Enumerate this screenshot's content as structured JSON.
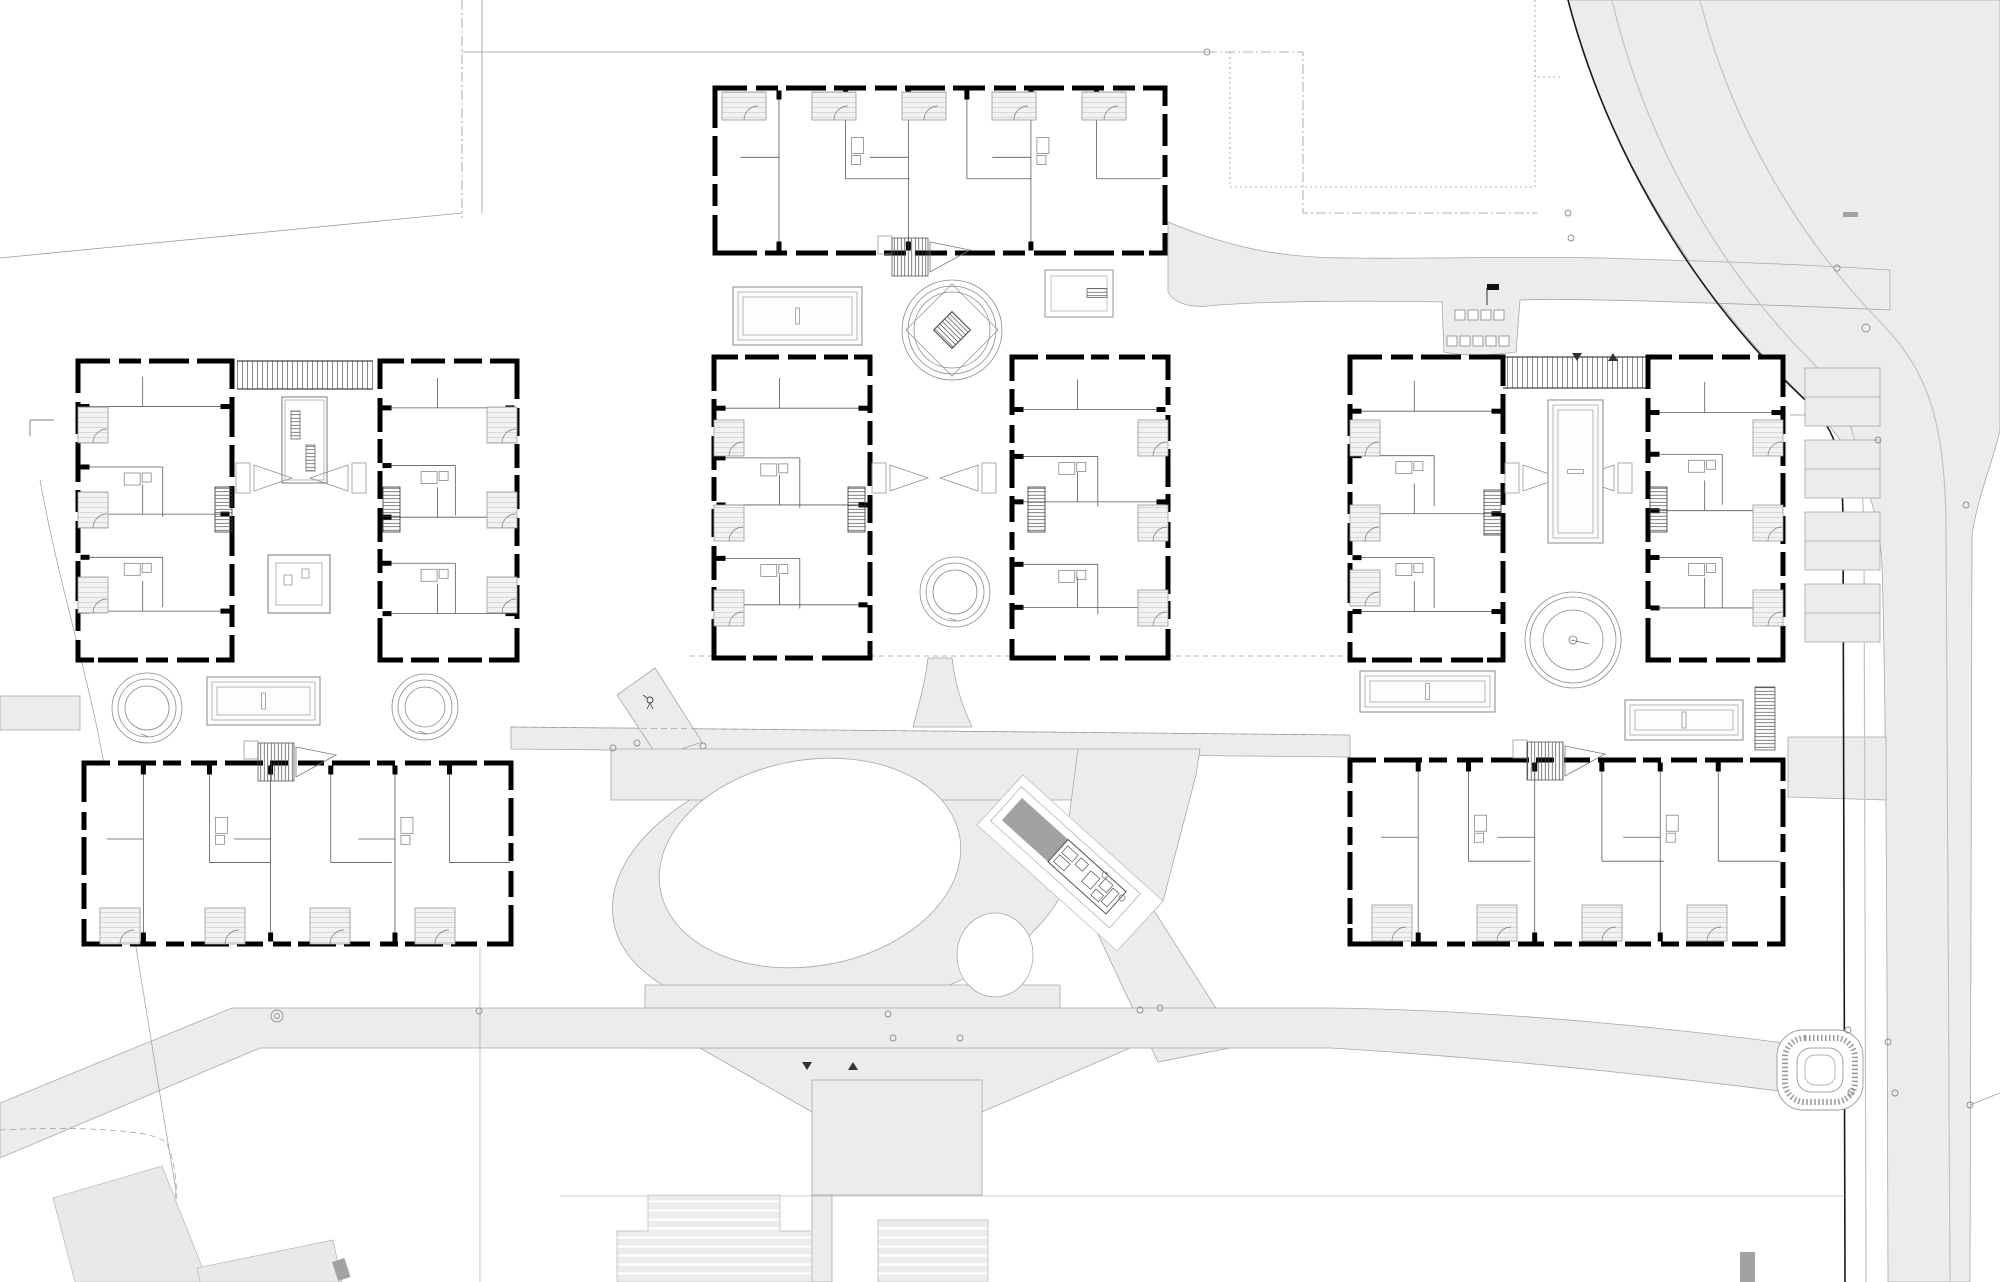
{
  "canvas": {
    "w": 2000,
    "h": 1282
  },
  "colors": {
    "paper": "#ffffff",
    "road_fill": "#ececec",
    "road_edge": "#a8a8a8",
    "wall": "#000000",
    "partition": "#5a5a5a",
    "faint_line": "#9a9a9a",
    "kerb": "#1a1a1a",
    "lane": "#c2c2c2",
    "context_fill": "#e9e9e9",
    "dark_object": "#a2a2a2",
    "hatch_line": "#4a4a4a"
  },
  "site": {
    "roads": [
      {
        "name": "east-road",
        "d": "M1568,0 H2000 V430 C1992,465 1978,495 1972,535 L1970,1282 H1888 C1887,900 1886,700 1882,565 C1878,485 1848,442 1798,392 C1702,298 1606,152 1568,0 Z"
      },
      {
        "name": "upper-path",
        "d": "M1168,222 C1240,252 1292,258 1352,258 C1432,259 1522,256 1602,258 C1702,261 1802,264 1890,270 L1890,310 C1702,302 1562,298 1520,300 L1516,352 C1488,356 1462,356 1444,352 L1442,302 C1330,300 1252,302 1208,306 C1184,308 1172,300 1168,292 Z"
      },
      {
        "name": "central-band-west",
        "d": "M0,696 H80 V730 H0 Z"
      },
      {
        "name": "central-band-mid",
        "d": "M511,727 L1350,735 L1350,757 L511,749 Z"
      },
      {
        "name": "central-band-east",
        "d": "M1788,737 L1886,737 L1886,800 L1788,797 Z"
      },
      {
        "name": "courtyard-funnel",
        "d": "M913,727 C920,700 926,678 928,658 L952,658 C955,684 962,706 972,727 Z"
      },
      {
        "name": "northwest-stub",
        "d": "M617,695 L655,668 L702,742 L658,757 Z"
      },
      {
        "name": "ring-bridge-north",
        "d": "M611,749 L1078,749 L1078,800 L611,800 Z"
      },
      {
        "name": "ring-bridge-south",
        "d": "M645,985 L1060,985 L1060,1048 L645,1048 Z"
      },
      {
        "name": "diagonal-link-north",
        "d": "M1078,749 L1200,749 L1196,775 L1163,901 L1117,951 L1062,872 Z"
      },
      {
        "name": "diagonal-link-south",
        "d": "M1096,930 L1146,898 L1240,1046 L1158,1062 Z"
      },
      {
        "name": "plaza-wedge",
        "d": "M700,1048 L1130,1048 L982,1112 L812,1112 Z"
      },
      {
        "name": "plaza",
        "d": "M812,1080 H982 V1195 H812 Z"
      },
      {
        "name": "plaza-stem",
        "d": "M812,1195 H832 V1282 H812 Z"
      },
      {
        "name": "bottom-road",
        "d": "M0,1103 L232,1008 L1330,1008 C1500,1010 1700,1030 1848,1052 L1848,1100 C1700,1080 1500,1058 1330,1048 L260,1048 L0,1158 Z"
      }
    ],
    "ring_ellipse": {
      "cx": 842,
      "cy": 881,
      "rx": 232,
      "ry": 131,
      "rot": -10
    },
    "white_islands": [
      {
        "name": "large-green-island",
        "cx": 810,
        "cy": 863,
        "rx": 152,
        "ry": 103,
        "rot": -10
      },
      {
        "name": "small-green-island",
        "cx": 995,
        "cy": 955,
        "rx": 38,
        "ry": 42,
        "rot": 0
      }
    ],
    "corridor_white": "977,825 1117,951 1163,901 1023,775",
    "lane_lines": [
      "M1612,0 C1645,140 1718,268 1812,362 C1852,404 1862,448 1864,530 L1866,1282",
      "M1700,0 C1730,120 1795,235 1884,326 C1932,376 1944,430 1946,520 L1950,1282"
    ],
    "kerb": "M1568,0 C1610,160 1700,300 1800,395 C1838,430 1842,450 1843,520 L1845,1282",
    "boundary_lines": [
      {
        "d": "M0,258 L462,213",
        "dash": "",
        "w": 0.8
      },
      {
        "d": "M482,0 L482,213",
        "dash": "",
        "w": 0.8
      },
      {
        "d": "M462,0 L462,218",
        "dash": "10 3 2 3",
        "w": 0.8
      },
      {
        "d": "M462,52 L1207,52",
        "dash": "",
        "w": 0.8
      },
      {
        "d": "M1207,52 L1303,52 L1303,213 L1537,213",
        "dash": "10 3 2 3",
        "w": 0.8
      },
      {
        "d": "M1230,52 L1230,187 L1535,187 L1535,52",
        "dash": "2 3",
        "w": 0.8
      },
      {
        "d": "M1535,0 L1535,77 L1563,77",
        "dash": "2 3",
        "w": 0.8
      },
      {
        "d": "M690,656 L1350,656",
        "dash": "5 4",
        "w": 0.7
      },
      {
        "d": "M511,727 L1350,735",
        "dash": "6 4",
        "w": 0.7
      },
      {
        "d": "M40,480 C60,590 90,680 105,770 C125,870 155,1070 176,1190 C172,1240 140,1262 115,1282",
        "dash": "",
        "w": 0.7
      },
      {
        "d": "M0,1130 C80,1126 150,1130 164,1141 C178,1153 180,1215 174,1282",
        "dash": "6 4",
        "w": 0.7
      },
      {
        "d": "M480,947 L480,1282",
        "dash": "",
        "w": 0.6
      },
      {
        "d": "M560,1196 L1845,1196",
        "dash": "",
        "w": 0.6
      },
      {
        "d": "M1970,1105 L2000,1093",
        "dash": "",
        "w": 0.7
      },
      {
        "d": "M30,420 L54,420 M30,420 L30,436",
        "dash": "",
        "w": 1.2
      },
      {
        "d": "M1790,415 L1806,415",
        "dash": "",
        "w": 0.8
      }
    ],
    "context_buildings": [
      {
        "name": "existing-building-sw-1",
        "pts": "53,1198 162,1166 208,1282 75,1282",
        "hatch": false
      },
      {
        "name": "existing-building-sw-2",
        "pts": "197,1268 333,1240 342,1282 200,1282",
        "hatch": false
      },
      {
        "name": "existing-building-s-1",
        "pts": "648,1195 780,1195 780,1231 812,1231 812,1282 617,1282 617,1231 648,1231",
        "hatch": true
      },
      {
        "name": "existing-building-s-2",
        "pts": "878,1220 988,1220 988,1282 878,1282",
        "hatch": true
      }
    ],
    "dark_objects": [
      {
        "x": 332,
        "y": 1262,
        "w": 13,
        "h": 20,
        "rot": -18
      },
      {
        "x": 1740,
        "y": 1252,
        "w": 15,
        "h": 30,
        "rot": 0
      },
      {
        "x": 1843,
        "y": 212,
        "w": 15,
        "h": 5,
        "rot": 0
      },
      {
        "x": 1806,
        "y": 400,
        "w": 5,
        "h": 16,
        "rot": 0
      }
    ],
    "parking": {
      "bays": [
        [
          1805,
          368
        ],
        [
          1805,
          440
        ],
        [
          1805,
          512
        ],
        [
          1805,
          584
        ]
      ],
      "bay_w": 75,
      "bay_h": 58
    },
    "mound": {
      "x": 1777,
      "y": 1030,
      "w": 86,
      "h": 80
    },
    "pavilion": {
      "x": 1022,
      "y": 798,
      "angle": 42,
      "dark_w": 62,
      "open_w": 78,
      "h": 30
    },
    "furniture": {
      "rows": [
        [
          1455,
          310,
          4
        ],
        [
          1447,
          336,
          5
        ]
      ],
      "size": 10,
      "gap": 13
    },
    "flag": {
      "x": 1487,
      "y": 284
    },
    "markers": [
      [
        277,
        1016,
        6
      ],
      [
        277,
        1016,
        2.5
      ],
      [
        479,
        1011,
        3
      ],
      [
        613,
        748,
        3
      ],
      [
        637,
        743,
        3
      ],
      [
        703,
        746,
        3
      ],
      [
        888,
        1014,
        3
      ],
      [
        893,
        1038,
        3
      ],
      [
        960,
        1038,
        3
      ],
      [
        1140,
        1010,
        3
      ],
      [
        1207,
        52,
        3
      ],
      [
        1568,
        213,
        3
      ],
      [
        1571,
        238,
        3
      ],
      [
        1837,
        268,
        3
      ],
      [
        1866,
        328,
        4
      ],
      [
        1878,
        440,
        3
      ],
      [
        1966,
        505,
        3
      ],
      [
        1848,
        1030,
        3
      ],
      [
        1888,
        1042,
        3
      ],
      [
        1851,
        1092,
        3
      ],
      [
        1895,
        1093,
        3
      ],
      [
        1970,
        1105,
        3
      ],
      [
        1122,
        898,
        3
      ],
      [
        1105,
        875,
        3
      ],
      [
        1160,
        1008,
        3
      ]
    ],
    "arrows": [
      [
        1572,
        353
      ],
      [
        1608,
        353
      ],
      [
        802,
        1062
      ],
      [
        848,
        1062
      ]
    ],
    "path_symbol": {
      "x": 650,
      "y": 700
    }
  },
  "clusters": [
    {
      "name": "west",
      "buildings": [
        {
          "name": "west-wing",
          "x": 78,
          "y": 361,
          "w": 154,
          "h": 299,
          "o": "v",
          "seed": 1
        },
        {
          "name": "east-wing",
          "x": 380,
          "y": 361,
          "w": 137,
          "h": 299,
          "o": "v",
          "seed": 2
        },
        {
          "name": "south-wing",
          "x": 84,
          "y": 763,
          "w": 427,
          "h": 181,
          "o": "h",
          "seed": 3
        }
      ],
      "pergolas": [
        [
          237,
          361,
          136,
          28
        ]
      ],
      "loggias": [
        [
          78,
          407,
          30,
          36
        ],
        [
          78,
          492,
          30,
          36
        ],
        [
          78,
          577,
          30,
          36
        ],
        [
          487,
          407,
          30,
          36
        ],
        [
          487,
          492,
          30,
          36
        ],
        [
          487,
          577,
          30,
          36
        ],
        [
          100,
          908,
          40,
          36
        ],
        [
          205,
          908,
          40,
          36
        ],
        [
          310,
          908,
          40,
          36
        ],
        [
          415,
          908,
          40,
          36
        ]
      ],
      "stairs": [
        [
          215,
          487,
          17,
          45
        ],
        [
          383,
          487,
          17,
          45
        ]
      ],
      "stair_entries": [
        [
          236,
          463,
          1
        ],
        [
          366,
          463,
          -1
        ]
      ],
      "ramps": [
        [
          258,
          743
        ]
      ],
      "pools": [
        [
          207,
          677,
          113,
          48
        ]
      ],
      "ring_planters": [
        [
          147,
          708,
          35
        ],
        [
          425,
          707,
          33
        ]
      ],
      "table_planters": [
        {
          "x": 282,
          "y": 397,
          "w": 45,
          "h": 86
        }
      ],
      "plaza_planters": [
        {
          "x": 268,
          "y": 555,
          "w": 62,
          "h": 58
        }
      ]
    },
    {
      "name": "center",
      "buildings": [
        {
          "name": "north-wing",
          "x": 715,
          "y": 88,
          "w": 450,
          "h": 165,
          "o": "h",
          "seed": 4
        },
        {
          "name": "west-wing",
          "x": 714,
          "y": 357,
          "w": 156,
          "h": 301,
          "o": "v",
          "seed": 5
        },
        {
          "name": "east-wing",
          "x": 1012,
          "y": 357,
          "w": 156,
          "h": 301,
          "o": "v",
          "seed": 6
        }
      ],
      "pergolas": [],
      "loggias": [
        [
          722,
          92,
          44,
          28
        ],
        [
          812,
          92,
          44,
          28
        ],
        [
          902,
          92,
          44,
          28
        ],
        [
          992,
          92,
          44,
          28
        ],
        [
          1082,
          92,
          44,
          28
        ],
        [
          714,
          420,
          30,
          36
        ],
        [
          714,
          505,
          30,
          36
        ],
        [
          714,
          590,
          30,
          36
        ],
        [
          1138,
          420,
          30,
          36
        ],
        [
          1138,
          505,
          30,
          36
        ],
        [
          1138,
          590,
          30,
          36
        ]
      ],
      "stairs": [
        [
          848,
          487,
          17,
          45
        ],
        [
          1028,
          487,
          17,
          45
        ]
      ],
      "stair_entries": [
        [
          872,
          463,
          1
        ],
        [
          996,
          463,
          -1
        ]
      ],
      "ramps": [
        [
          892,
          238
        ]
      ],
      "pools": [
        [
          733,
          287,
          129,
          58
        ]
      ],
      "fountain": {
        "cx": 952,
        "cy": 330,
        "r": 50
      },
      "triple_rings": [
        [
          955,
          592,
          35
        ]
      ],
      "benches": [
        {
          "x": 1045,
          "y": 270,
          "w": 68,
          "h": 47
        }
      ]
    },
    {
      "name": "east",
      "buildings": [
        {
          "name": "west-wing",
          "x": 1350,
          "y": 357,
          "w": 153,
          "h": 303,
          "o": "v",
          "seed": 7
        },
        {
          "name": "east-wing",
          "x": 1648,
          "y": 357,
          "w": 135,
          "h": 303,
          "o": "v",
          "seed": 8
        },
        {
          "name": "south-wing",
          "x": 1350,
          "y": 760,
          "w": 433,
          "h": 184,
          "o": "h",
          "seed": 9
        }
      ],
      "pergolas": [
        [
          1503,
          357,
          145,
          31
        ]
      ],
      "loggias": [
        [
          1350,
          420,
          30,
          36
        ],
        [
          1350,
          505,
          30,
          36
        ],
        [
          1350,
          570,
          30,
          36
        ],
        [
          1753,
          420,
          30,
          36
        ],
        [
          1753,
          505,
          30,
          36
        ],
        [
          1753,
          590,
          30,
          36
        ],
        [
          1372,
          905,
          40,
          36
        ],
        [
          1477,
          905,
          40,
          36
        ],
        [
          1582,
          905,
          40,
          36
        ],
        [
          1687,
          905,
          40,
          36
        ]
      ],
      "stairs": [
        [
          1484,
          490,
          17,
          45
        ],
        [
          1650,
          487,
          17,
          45
        ]
      ],
      "stair_entries": [
        [
          1505,
          463,
          1
        ],
        [
          1632,
          463,
          -1
        ]
      ],
      "ramps": [
        [
          1527,
          742
        ]
      ],
      "pools": [
        [
          1360,
          671,
          135,
          41
        ],
        [
          1625,
          700,
          118,
          40
        ],
        [
          1548,
          400,
          55,
          143
        ]
      ],
      "big_circle": {
        "cx": 1573,
        "cy": 640,
        "r": 48
      },
      "stair_blocks": [
        [
          1755,
          687,
          20,
          63
        ]
      ]
    }
  ]
}
